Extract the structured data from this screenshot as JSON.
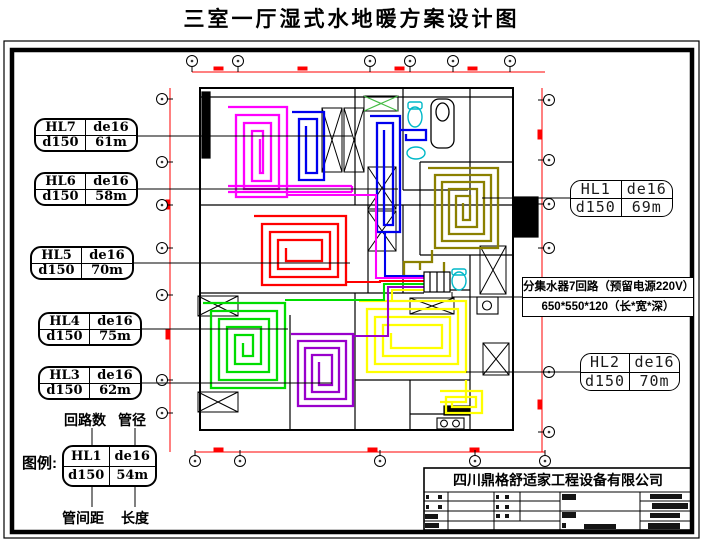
{
  "title": "三室一厅湿式水地暖方案设计图",
  "loops": [
    {
      "id": "HL7",
      "pipe": "de16",
      "spacing": "d150",
      "length": "61m",
      "color": "#FF00FF"
    },
    {
      "id": "HL6",
      "pipe": "de16",
      "spacing": "d150",
      "length": "58m",
      "color": "#0000EE"
    },
    {
      "id": "HL5",
      "pipe": "de16",
      "spacing": "d150",
      "length": "70m",
      "color": "#FF0000"
    },
    {
      "id": "HL4",
      "pipe": "de16",
      "spacing": "d150",
      "length": "75m",
      "color": "#00DD00"
    },
    {
      "id": "HL3",
      "pipe": "de16",
      "spacing": "d150",
      "length": "62m",
      "color": "#9900CC"
    },
    {
      "id": "HL1",
      "pipe": "de16",
      "spacing": "d150",
      "length": "69m",
      "color": "#8B8000"
    },
    {
      "id": "HL2",
      "pipe": "de16",
      "spacing": "d150",
      "length": "70m",
      "color": "#FFFF00"
    }
  ],
  "manifold_note": {
    "line1": "分集水器7回路（预留电源220V）",
    "line2": "650*550*120（长*宽*深）"
  },
  "legend": {
    "label": "图例:",
    "annotations": {
      "top_left": "回路数",
      "top_right": "管径",
      "bottom_left": "管间距",
      "bottom_right": "长度"
    },
    "sample": {
      "id": "HL1",
      "pipe": "de16",
      "spacing": "d150",
      "length": "54m"
    }
  },
  "title_block": {
    "company": "四川鼎格舒适家工程设备有限公司"
  },
  "colors": {
    "dimension": "#FF0000",
    "wall": "#000000",
    "fixture": "#00B8C8",
    "hatch_green": "#44BB44"
  }
}
